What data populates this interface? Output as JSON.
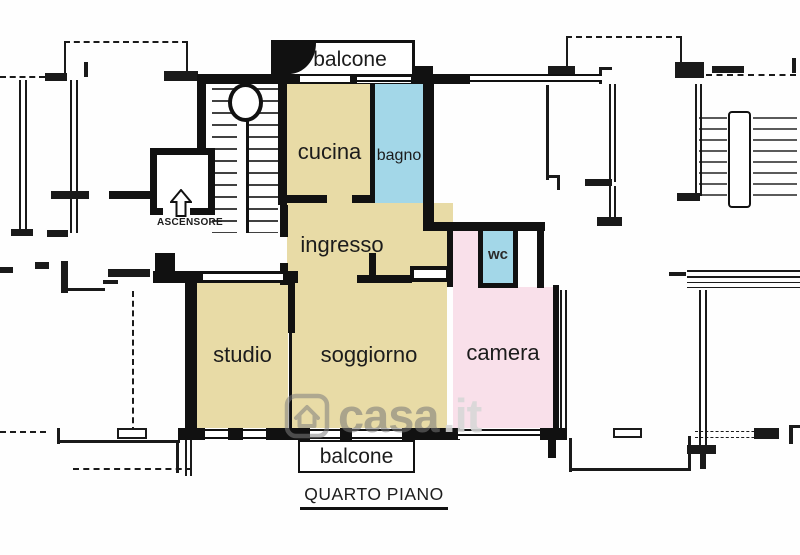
{
  "floor_plan": {
    "caption": "QUARTO PIANO",
    "labels": {
      "balcone_top": "balcone",
      "cucina": "cucina",
      "bagno": "bagno",
      "ingresso": "ingresso",
      "ascensore": "ASCENSORE",
      "wc": "wc",
      "studio": "studio",
      "soggiorno": "soggiorno",
      "camera": "camera",
      "balcone_bottom": "balcone"
    },
    "watermark": {
      "brand": "casa",
      "tld": ".it",
      "icon": "house-icon"
    },
    "colors": {
      "main_rooms": "#e8dba6",
      "bathrooms": "#a3d7e8",
      "bedroom": "#f9e0ea",
      "walls": "#111111"
    }
  }
}
